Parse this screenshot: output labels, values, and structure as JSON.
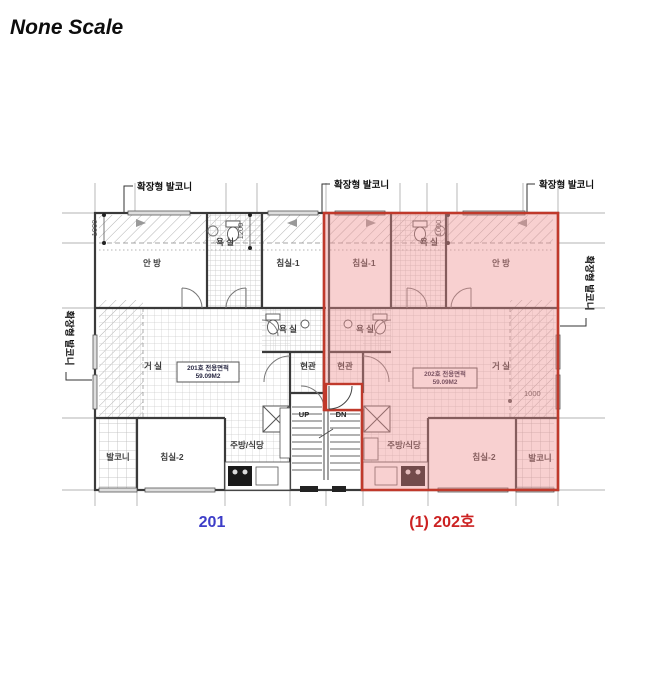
{
  "title": "None Scale",
  "callouts": {
    "balcony": "확장형 발코니"
  },
  "dims": {
    "d_left": "1000",
    "d_mid": "1200",
    "d_right": "1000",
    "d_living": "1000"
  },
  "stairs": {
    "up": "UP",
    "dn": "DN"
  },
  "unit201": {
    "number": "201",
    "rooms": {
      "master": "안 방",
      "bath1": "욕 실",
      "bed1": "침실-1",
      "bath2": "욕 실",
      "living": "거 실",
      "entry": "현관",
      "balcony": "발코니",
      "bed2": "침실-2",
      "kitchen": "주방/식당"
    },
    "area_title": "201호 전용면적",
    "area_value": "59.09M2"
  },
  "unit202": {
    "number": "(1) 202호",
    "rooms": {
      "master": "안 방",
      "bath1": "욕 실",
      "bed1": "침실-1",
      "bath2": "욕 실",
      "living": "거 실",
      "entry": "현관",
      "balcony": "발코니",
      "bed2": "침실-2",
      "kitchen": "주방/식당"
    },
    "area_title": "202호 전용면적",
    "area_value": "59.09M2"
  },
  "colors": {
    "unit201_label": "#3d3dc8",
    "unit202_label": "#cc2222",
    "highlight_fill": "#ee8f8f",
    "highlight_border": "#c0392b",
    "wall": "#3a3a3a"
  }
}
